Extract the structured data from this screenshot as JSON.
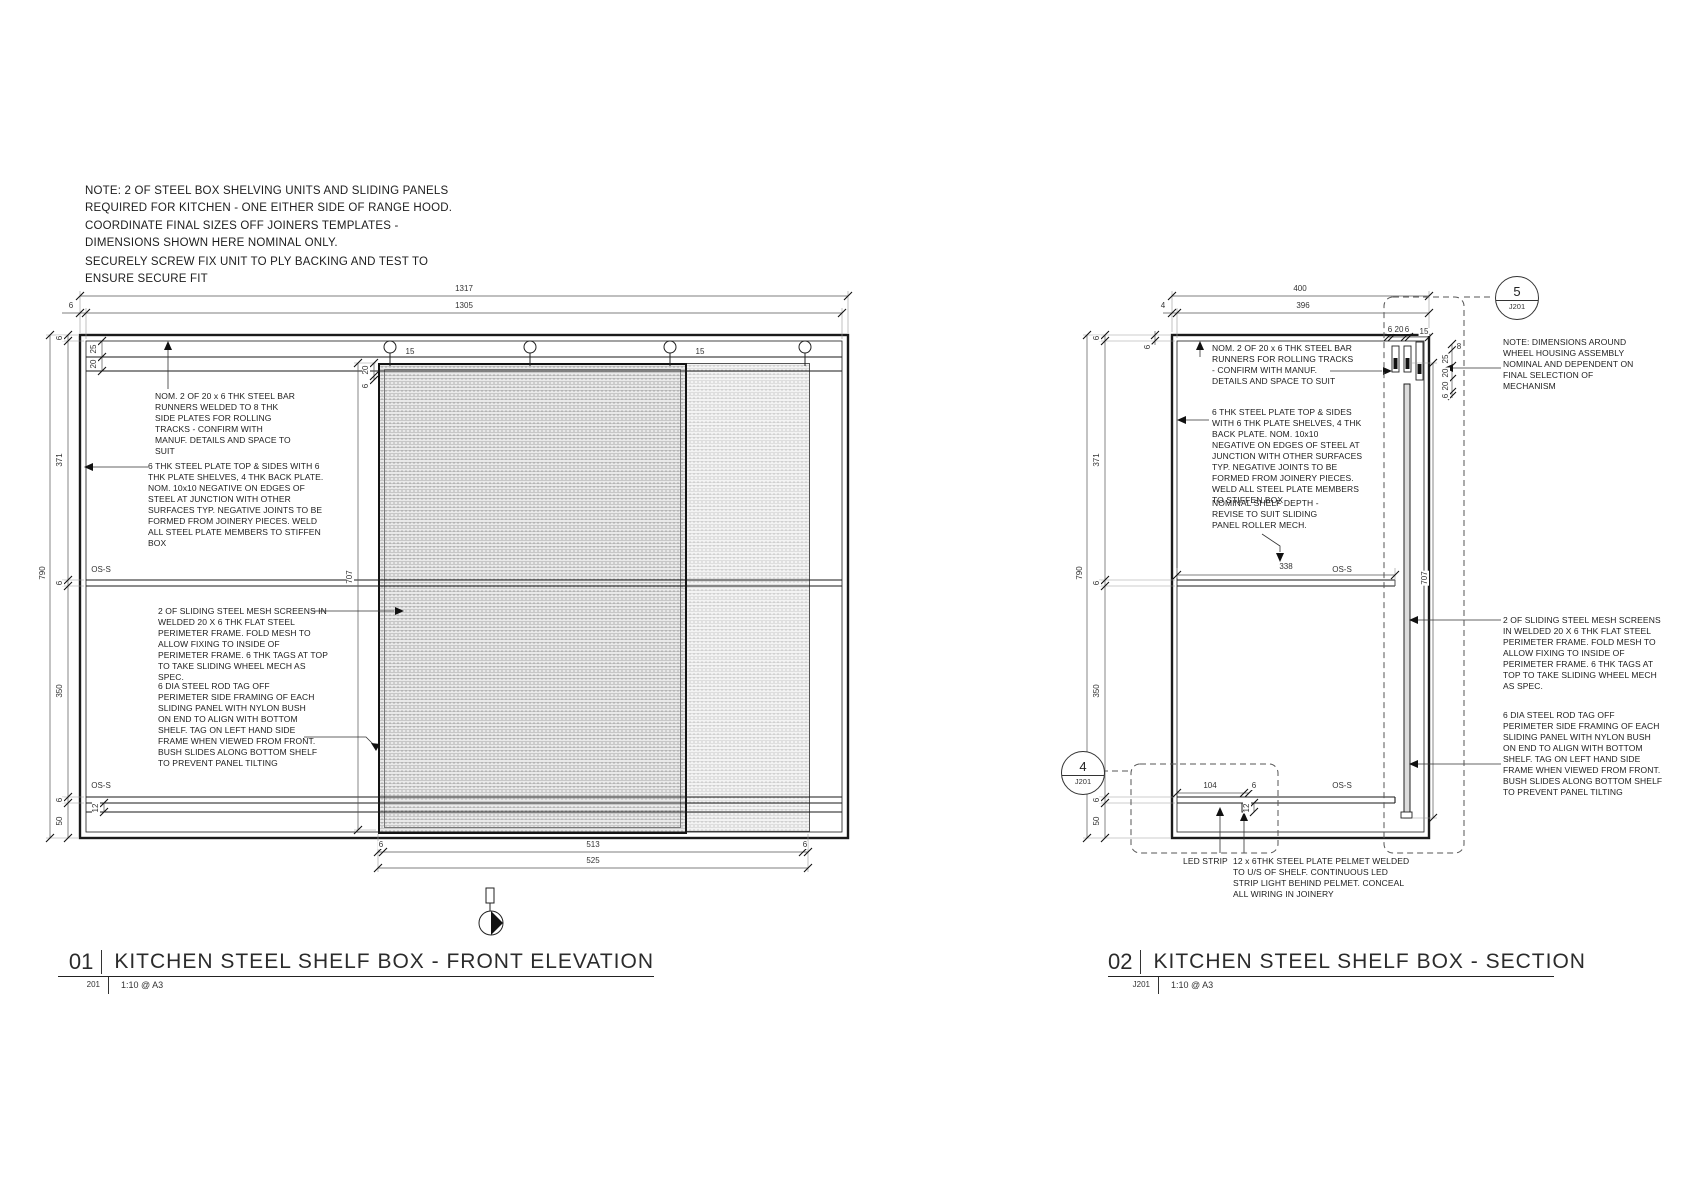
{
  "notes": {
    "general": "NOTE: 2 OF STEEL BOX SHELVING UNITS AND SLIDING PANELS REQUIRED FOR KITCHEN - ONE EITHER SIDE OF RANGE HOOD. COORDINATE FINAL SIZES OFF JOINERS TEMPLATES - DIMENSIONS SHOWN HERE NOMINAL ONLY.",
    "fixing": "SECURELY SCREW FIX UNIT TO PLY BACKING AND TEST TO ENSURE SECURE FIT"
  },
  "drawing1": {
    "number": "01",
    "title": "KITCHEN STEEL SHELF BOX - FRONT ELEVATION",
    "ref": "201",
    "scale": "1:10 @ A3",
    "annotations": {
      "runners": "NOM. 2 OF 20 x 6 THK STEEL BAR RUNNERS WELDED TO 8 THK SIDE PLATES FOR ROLLING TRACKS - CONFIRM WITH MANUF. DETAILS AND SPACE TO SUIT",
      "plate_box": "6 THK STEEL PLATE TOP & SIDES WITH 6 THK PLATE SHELVES, 4 THK BACK PLATE. NOM. 10x10 NEGATIVE ON EDGES OF STEEL AT JUNCTION WITH OTHER SURFACES TYP. NEGATIVE JOINTS TO BE FORMED FROM JOINERY PIECES. WELD ALL STEEL PLATE MEMBERS TO STIFFEN BOX",
      "mesh_screens": "2 OF SLIDING STEEL MESH SCREENS IN WELDED 20 X 6 THK FLAT STEEL PERIMETER FRAME. FOLD MESH TO ALLOW FIXING TO INSIDE OF PERIMETER FRAME. 6 THK TAGS AT TOP TO TAKE SLIDING WHEEL MECH AS SPEC.",
      "rod_tag": "6 DIA STEEL ROD TAG OFF PERIMETER SIDE FRAMING OF EACH SLIDING PANEL WITH NYLON BUSH ON END TO ALIGN WITH BOTTOM SHELF. TAG ON LEFT HAND SIDE FRAME WHEN VIEWED FROM FRONT. BUSH SLIDES ALONG BOTTOM SHELF TO PREVENT PANEL TILTING"
    },
    "dim_labels": [
      {
        "t": "1317",
        "x": 464,
        "y": 289
      },
      {
        "t": "1305",
        "x": 464,
        "y": 306
      },
      {
        "t": "6",
        "x": 71,
        "y": 306
      },
      {
        "t": "790",
        "x": 43,
        "y": 573,
        "r": -90
      },
      {
        "t": "6",
        "x": 60,
        "y": 338,
        "r": -90
      },
      {
        "t": "371",
        "x": 60,
        "y": 460,
        "r": -90
      },
      {
        "t": "6",
        "x": 60,
        "y": 583,
        "r": -90
      },
      {
        "t": "350",
        "x": 60,
        "y": 691,
        "r": -90
      },
      {
        "t": "6",
        "x": 60,
        "y": 800,
        "r": -90
      },
      {
        "t": "50",
        "x": 60,
        "y": 821,
        "r": -90
      },
      {
        "t": "25",
        "x": 94,
        "y": 349,
        "r": -90
      },
      {
        "t": "20",
        "x": 94,
        "y": 364,
        "r": -90
      },
      {
        "t": "20",
        "x": 366,
        "y": 370,
        "r": -90
      },
      {
        "t": "6",
        "x": 366,
        "y": 386,
        "r": -90
      },
      {
        "t": "15",
        "x": 410,
        "y": 352
      },
      {
        "t": "15",
        "x": 700,
        "y": 352
      },
      {
        "t": "707",
        "x": 350,
        "y": 577,
        "r": -90
      },
      {
        "t": "12",
        "x": 96,
        "y": 808,
        "r": -90
      },
      {
        "t": "6",
        "x": 381,
        "y": 845
      },
      {
        "t": "513",
        "x": 593,
        "y": 845
      },
      {
        "t": "6",
        "x": 805,
        "y": 845
      },
      {
        "t": "525",
        "x": 593,
        "y": 861
      },
      {
        "t": "OS-S",
        "x": 101,
        "y": 570
      },
      {
        "t": "OS-S",
        "x": 101,
        "y": 786
      }
    ]
  },
  "drawing2": {
    "number": "02",
    "title": "KITCHEN STEEL SHELF BOX - SECTION",
    "ref": "J201",
    "scale": "1:10 @ A3",
    "callouts": [
      {
        "number": "5",
        "sheet": "J201"
      },
      {
        "number": "4",
        "sheet": "J201"
      }
    ],
    "annotations": {
      "runners": "NOM. 2 OF 20 x 6 THK STEEL BAR RUNNERS FOR ROLLING TRACKS - CONFIRM WITH MANUF. DETAILS AND SPACE TO SUIT",
      "plate_box": "6 THK STEEL PLATE TOP & SIDES WITH 6 THK PLATE SHELVES, 4 THK BACK PLATE. NOM. 10x10 NEGATIVE ON EDGES OF STEEL AT JUNCTION WITH OTHER SURFACES TYP. NEGATIVE JOINTS TO BE FORMED FROM JOINERY PIECES. WELD ALL STEEL PLATE MEMBERS TO STIFFEN BOX",
      "shelf_depth": "NOMINAL SHELF DEPTH - REVISE TO SUIT SLIDING PANEL ROLLER MECH.",
      "wheel_note": "NOTE: DIMENSIONS AROUND WHEEL HOUSING ASSEMBLY NOMINAL AND DEPENDENT ON FINAL SELECTION OF MECHANISM",
      "mesh_screens": "2 OF SLIDING STEEL MESH SCREENS IN WELDED 20 X 6 THK FLAT STEEL PERIMETER FRAME. FOLD MESH TO ALLOW FIXING TO INSIDE OF PERIMETER FRAME. 6 THK TAGS AT TOP TO TAKE SLIDING WHEEL MECH AS SPEC.",
      "rod_tag": "6 DIA STEEL ROD TAG OFF PERIMETER SIDE FRAMING OF EACH SLIDING PANEL WITH NYLON BUSH ON END TO ALIGN WITH BOTTOM SHELF. TAG ON LEFT HAND SIDE FRAME WHEN VIEWED FROM FRONT. BUSH SLIDES ALONG BOTTOM SHELF TO PREVENT PANEL TILTING",
      "led": "LED STRIP",
      "pelmet": "12 x 6THK STEEL PLATE PELMET WELDED TO U/S OF SHELF. CONTINUOUS LED STRIP LIGHT BEHIND PELMET. CONCEAL ALL WIRING IN JOINERY"
    },
    "dim_labels": [
      {
        "t": "400",
        "x": 1300,
        "y": 289
      },
      {
        "t": "396",
        "x": 1303,
        "y": 306
      },
      {
        "t": "4",
        "x": 1163,
        "y": 306
      },
      {
        "t": "790",
        "x": 1080,
        "y": 573,
        "r": -90
      },
      {
        "t": "6",
        "x": 1097,
        "y": 338,
        "r": -90
      },
      {
        "t": "371",
        "x": 1097,
        "y": 460,
        "r": -90
      },
      {
        "t": "6",
        "x": 1097,
        "y": 583,
        "r": -90
      },
      {
        "t": "350",
        "x": 1097,
        "y": 691,
        "r": -90
      },
      {
        "t": "6",
        "x": 1097,
        "y": 800,
        "r": -90
      },
      {
        "t": "50",
        "x": 1097,
        "y": 821,
        "r": -90
      },
      {
        "t": "6",
        "x": 1148,
        "y": 347,
        "r": -90
      },
      {
        "t": "6",
        "x": 1390,
        "y": 330
      },
      {
        "t": "20",
        "x": 1399,
        "y": 330
      },
      {
        "t": "6",
        "x": 1407,
        "y": 330
      },
      {
        "t": "15",
        "x": 1424,
        "y": 332
      },
      {
        "t": "8",
        "x": 1459,
        "y": 347
      },
      {
        "t": "25",
        "x": 1446,
        "y": 359,
        "r": -90
      },
      {
        "t": "20",
        "x": 1446,
        "y": 373,
        "r": -90
      },
      {
        "t": "20",
        "x": 1446,
        "y": 386,
        "r": -90
      },
      {
        "t": "6",
        "x": 1446,
        "y": 396,
        "r": -90
      },
      {
        "t": "707",
        "x": 1425,
        "y": 578,
        "r": -90
      },
      {
        "t": "338",
        "x": 1286,
        "y": 567
      },
      {
        "t": "104",
        "x": 1210,
        "y": 786
      },
      {
        "t": "6",
        "x": 1254,
        "y": 786
      },
      {
        "t": "12",
        "x": 1247,
        "y": 808,
        "r": -90
      },
      {
        "t": "OS-S",
        "x": 1342,
        "y": 570
      },
      {
        "t": "OS-S",
        "x": 1342,
        "y": 786
      }
    ]
  }
}
